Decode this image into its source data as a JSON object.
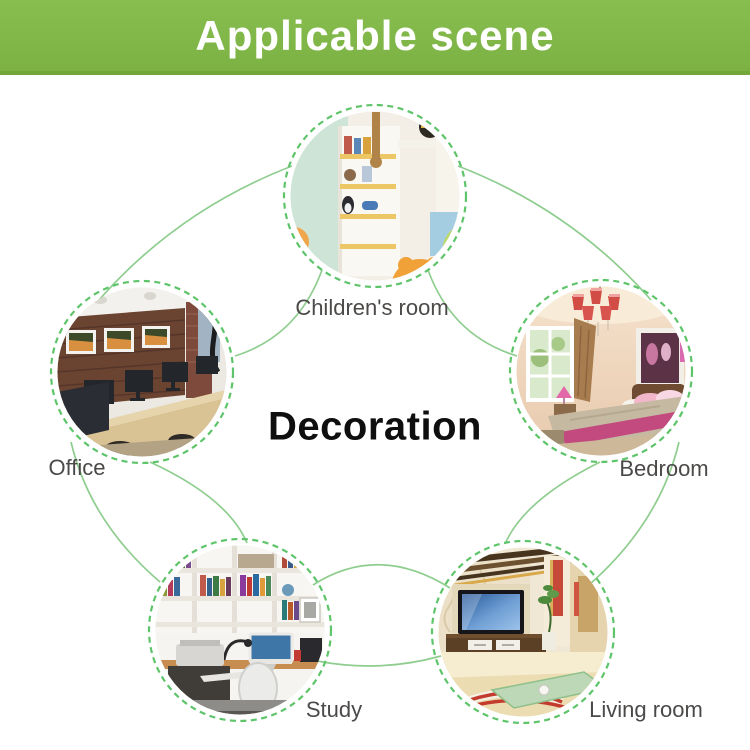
{
  "banner": {
    "title": "Applicable scene"
  },
  "center_title": "Decoration",
  "nodes": {
    "children_room": {
      "label": "Children's room"
    },
    "office": {
      "label": "Office"
    },
    "bedroom": {
      "label": "Bedroom"
    },
    "study": {
      "label": "Study"
    },
    "living_room": {
      "label": "Living room"
    }
  },
  "colors": {
    "banner_green": "#7cb243",
    "banner_green_dark": "#73a73a",
    "connector_green": "#8fcd8f",
    "ring_green": "#5ec46a",
    "label_gray": "#4c4a48",
    "title_black": "#0f0f0f"
  }
}
